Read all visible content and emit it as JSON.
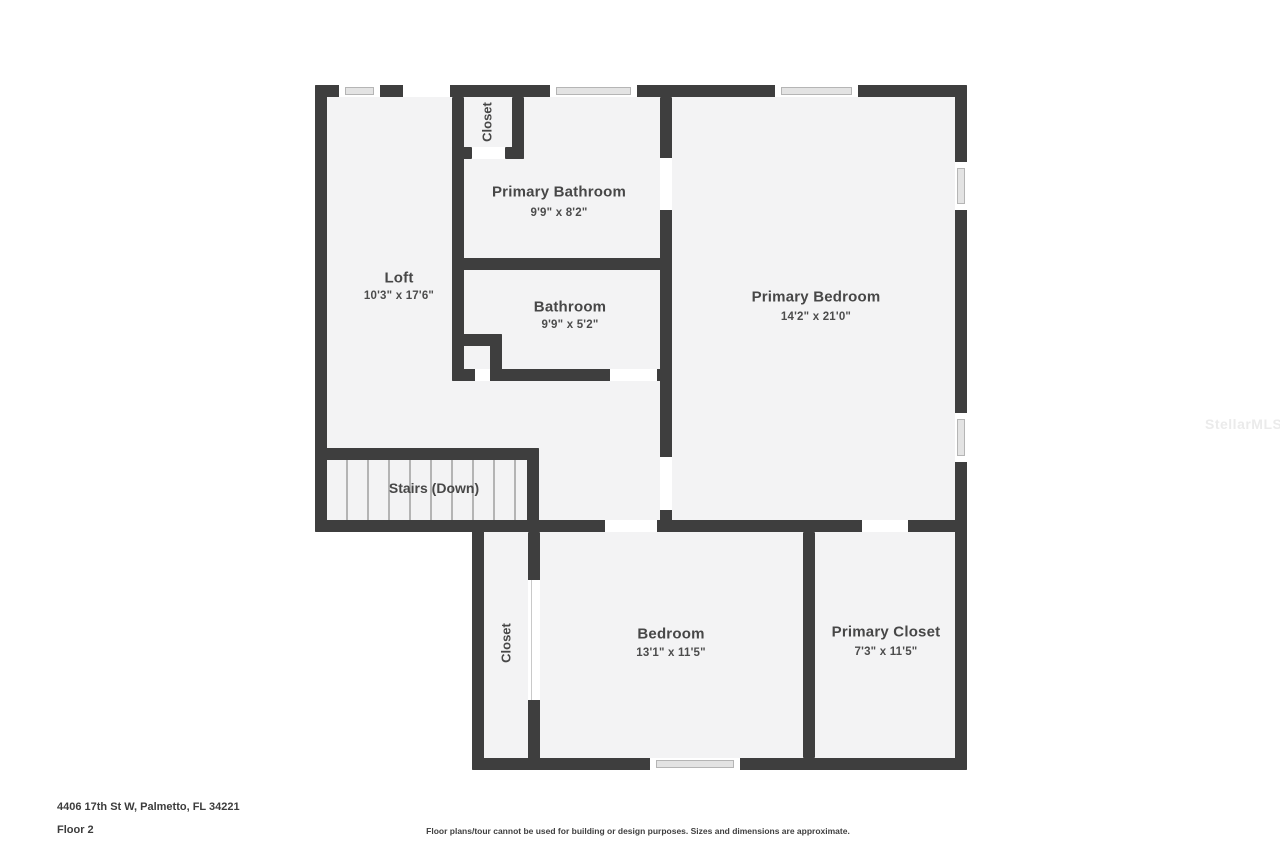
{
  "floor_plan": {
    "watermark": "StellarMLS",
    "rooms": {
      "closet_upper": {
        "name": "Closet"
      },
      "primary_bathroom": {
        "name": "Primary Bathroom",
        "dims": "9'9\" x 8'2\""
      },
      "loft": {
        "name": "Loft",
        "dims": "10'3\" x 17'6\""
      },
      "bathroom": {
        "name": "Bathroom",
        "dims": "9'9\" x 5'2\""
      },
      "primary_bedroom": {
        "name": "Primary Bedroom",
        "dims": "14'2\" x 21'0\""
      },
      "stairs": {
        "name": "Stairs (Down)"
      },
      "closet_lower": {
        "name": "Closet"
      },
      "bedroom": {
        "name": "Bedroom",
        "dims": "13'1\" x 11'5\""
      },
      "primary_closet": {
        "name": "Primary Closet",
        "dims": "7'3\" x 11'5\""
      }
    },
    "footer": {
      "address": "4406 17th St W, Palmetto, FL 34221",
      "floor_label": "Floor 2",
      "disclaimer": "Floor plans/tour cannot be used for building or design purposes. Sizes and dimensions are approximate."
    },
    "colors": {
      "wall": "#3e3e3e",
      "floor": "#f3f3f4",
      "window_glass": "#e3e3e3"
    }
  }
}
